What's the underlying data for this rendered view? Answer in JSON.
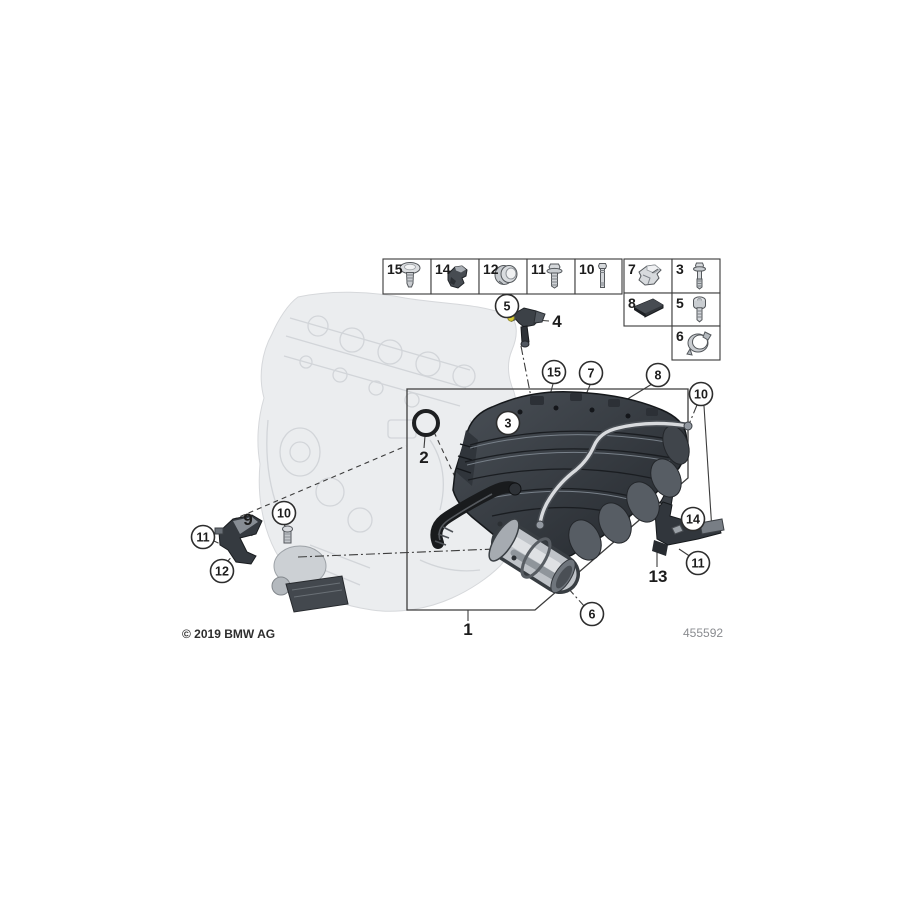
{
  "footer": {
    "copyright": "© 2019 BMW AG",
    "diagram_number": "455592"
  },
  "colors": {
    "highlight": "#d6c832",
    "line": "#3a3a3a"
  },
  "parts_table": {
    "cells": [
      {
        "label": "15",
        "icon": "screw-flat",
        "x": 383,
        "y": 259,
        "w": 48,
        "h": 35
      },
      {
        "label": "14",
        "icon": "clip-dark",
        "x": 431,
        "y": 259,
        "w": 48,
        "h": 35
      },
      {
        "label": "12",
        "icon": "grommet",
        "x": 479,
        "y": 259,
        "w": 48,
        "h": 35
      },
      {
        "label": "11",
        "icon": "bolt-hex",
        "x": 527,
        "y": 259,
        "w": 48,
        "h": 35
      },
      {
        "label": "10",
        "icon": "stud",
        "x": 575,
        "y": 259,
        "w": 47,
        "h": 35
      },
      {
        "label": "7",
        "icon": "clip-metal",
        "x": 624,
        "y": 259,
        "w": 48,
        "h": 34
      },
      {
        "label": "3",
        "icon": "screw-long",
        "x": 672,
        "y": 259,
        "w": 48,
        "h": 34
      },
      {
        "label": "8",
        "icon": "pad",
        "x": 624,
        "y": 293,
        "w": 48,
        "h": 33
      },
      {
        "label": "5",
        "icon": "bolt-cyl",
        "x": 672,
        "y": 293,
        "w": 48,
        "h": 33
      },
      {
        "label": "6",
        "icon": "clamp",
        "x": 672,
        "y": 326,
        "w": 48,
        "h": 34
      }
    ]
  },
  "callouts": [
    {
      "label": "5",
      "x": 507,
      "y": 306
    },
    {
      "label": "15",
      "x": 554,
      "y": 372
    },
    {
      "label": "7",
      "x": 591,
      "y": 373
    },
    {
      "label": "8",
      "x": 658,
      "y": 375
    },
    {
      "label": "10",
      "x": 701,
      "y": 394
    },
    {
      "label": "3",
      "x": 508,
      "y": 423
    },
    {
      "label": "10",
      "x": 284,
      "y": 513
    },
    {
      "label": "11",
      "x": 203,
      "y": 537
    },
    {
      "label": "12",
      "x": 222,
      "y": 571
    },
    {
      "label": "14",
      "x": 693,
      "y": 519
    },
    {
      "label": "11",
      "x": 698,
      "y": 563
    },
    {
      "label": "6",
      "x": 592,
      "y": 614
    }
  ],
  "labels": [
    {
      "text": "1",
      "x": 468,
      "y": 629
    },
    {
      "text": "2",
      "x": 424,
      "y": 457
    },
    {
      "text": "4",
      "x": 557,
      "y": 321
    },
    {
      "text": "9",
      "x": 248,
      "y": 519
    },
    {
      "text": "13",
      "x": 658,
      "y": 576
    }
  ]
}
